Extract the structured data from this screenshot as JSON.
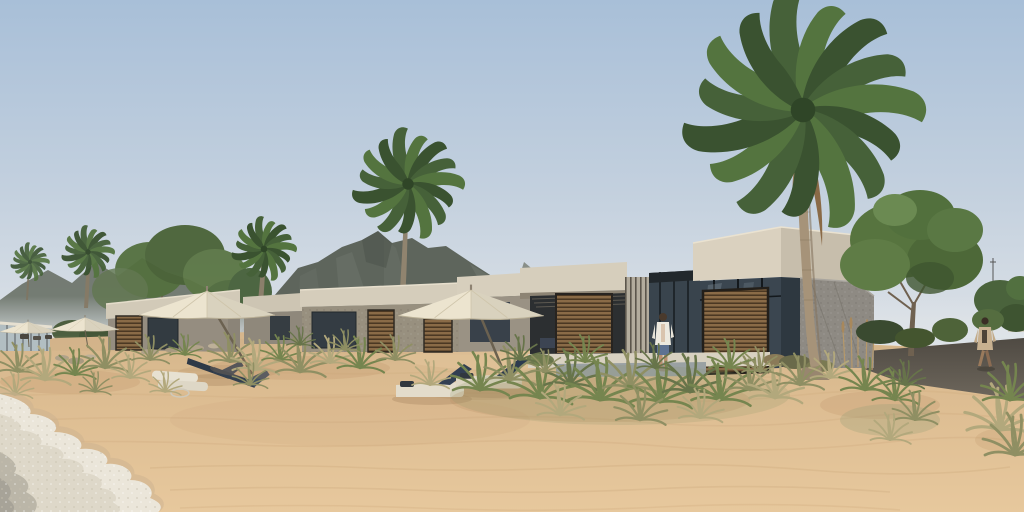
{
  "scene": {
    "type": "architectural-rendering",
    "description": "3D rendering of a beachfront resort: a receding row of flat-roofed stone villas with timber louver screens and glass walls, white canvas beach umbrellas, sun loungers on sandy dunes with beach grass, palm trees and green trees, a hazy mountain backdrop, and foamy surf washing onto the sand in the lower-left corner.",
    "time_of_day": "day",
    "weather": "clear"
  },
  "palette": {
    "sky_top": "#a8bfd8",
    "sky_horizon": "#dde2e7",
    "mountain_far": "#6f766d",
    "mountain_main": "#5e655c",
    "haze": "#dfe4e8",
    "villa_fascia": "#d6cebc",
    "villa_stone": "#98907f",
    "timber_louver": "#8a6b47",
    "glass": "#3a4750",
    "umbrella_canvas": "#ece4cf",
    "lounger_navy": "#323f52",
    "lounger_cream": "#e3dccb",
    "sand": "#ddbd92",
    "dune_grass_olive": "#8f8f63",
    "palm_green": "#466139",
    "tree_green": "#57743f",
    "pathway": "#5d574e",
    "sea_foam": "#ebe6da",
    "skin": "#b98e6f",
    "denim_shorts": "#5d7292",
    "tan_outfit": "#c8b190"
  },
  "inventory": {
    "villa_blocks": 6,
    "beach_umbrellas": 4,
    "sun_loungers": 6,
    "palm_trees": 5,
    "broadleaf_trees": 4,
    "people": 2,
    "mountain_ranges": 2,
    "shoreline_position": "lower-left",
    "dune_grass_clusters": "many"
  }
}
